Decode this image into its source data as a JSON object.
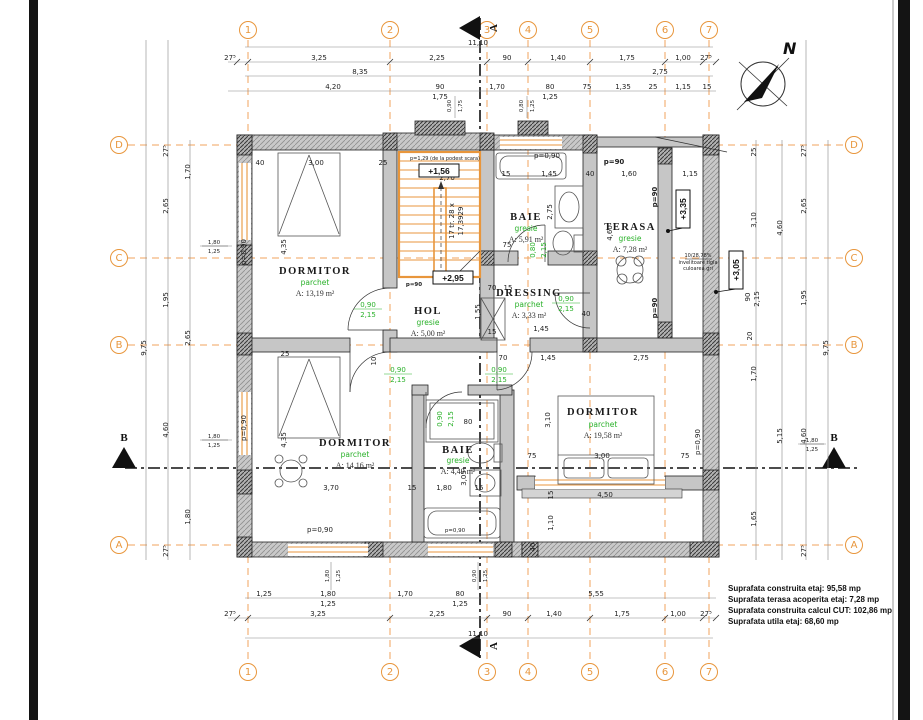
{
  "colors": {
    "axis": "#F0A35E",
    "finish_green": "#2AB12A",
    "wall_gray": "#C6C6C6"
  },
  "north": "N",
  "grid": {
    "cols": [
      "1",
      "2",
      "3",
      "4",
      "5",
      "6",
      "7"
    ],
    "rows": [
      "D",
      "C",
      "B",
      "A"
    ]
  },
  "section": {
    "vertical": "A",
    "horizontal": "B"
  },
  "rooms": [
    {
      "name": "DORMITOR",
      "finish": "parchet",
      "area": "A: 13,19 m²"
    },
    {
      "name": "HOL",
      "finish": "gresie",
      "area": "A: 5,00 m²"
    },
    {
      "name": "BAIE",
      "finish": "gresie",
      "area": "A: 5,91 m²"
    },
    {
      "name": "DRESSING",
      "finish": "parchet",
      "area": "A: 3,33 m²"
    },
    {
      "name": "TERASA",
      "finish": "gresie",
      "area": "A: 7,28 m²"
    },
    {
      "name": "DORMITOR",
      "finish": "parchet",
      "area": "A: 19,58 m²"
    },
    {
      "name": "DORMITOR",
      "finish": "parchet",
      "area": "A: 14,16 m²"
    },
    {
      "name": "BAIE",
      "finish": "gresie",
      "area": "A: 4,49 m²"
    }
  ],
  "levels": {
    "l1": "+1,56",
    "l2": "+2,95",
    "l3": "+3,35",
    "l4": "+3,05"
  },
  "stairs": {
    "note": "p=1,29 (de la podest scara)",
    "line1": "17 tr. 28 x",
    "line2": "17,3929"
  },
  "roof": {
    "l1": "10/28,78%",
    "l2": "invelitoare tigla",
    "l3": "culoarea gri"
  },
  "lbl": {
    "p090": "p=0,90",
    "p90": "p=90",
    "d09": "0,90",
    "d08": "0,80",
    "d215": "2,15"
  },
  "summary": [
    "Suprafata construita etaj: 95,58 mp",
    "Suprafata terasa acoperita etaj: 7,28 mp",
    "Suprafata construita calcul CUT: 102,86 mp",
    "Suprafata utila etaj: 68,60 mp"
  ],
  "dims": {
    "t1": [
      "11,10"
    ],
    "t2": [
      "27⁵",
      "3,25",
      "2,25",
      "90",
      "1,40",
      "1,75",
      "1,00",
      "27⁵"
    ],
    "t3": [
      "8,35",
      "2,75"
    ],
    "t4": [
      "4,20",
      "90",
      "1,75",
      "1,70",
      "80",
      "1,25",
      "75",
      "1,35",
      "25",
      "1,15",
      "15"
    ],
    "ts": [
      "0,90",
      "1,75",
      "0,80",
      "1,25"
    ],
    "b1": [
      "1,25",
      "1,80",
      "1,25",
      "1,70",
      "80",
      "1,25",
      "5,55"
    ],
    "b2": [
      "27⁵",
      "3,25",
      "2,25",
      "90",
      "1,40",
      "1,75",
      "1,00",
      "27⁵"
    ],
    "b3": [
      "11,10"
    ],
    "bs": [
      "1,80",
      "1,25",
      "0,90",
      "1,25"
    ],
    "l": [
      "9,75",
      "27⁵",
      "1,70",
      "2,65",
      "1,80",
      "1,25",
      "1,95",
      "2,65",
      "4,60",
      "1,80",
      "1,25",
      "1,80",
      "27⁵"
    ],
    "r": [
      "25",
      "3,10",
      "4,60",
      "90",
      "2,15",
      "20",
      "1,70",
      "27⁵",
      "2,65",
      "1,95",
      "9,75",
      "4,60",
      "5,15",
      "1,80",
      "1,25",
      "1,65",
      "27⁵"
    ],
    "i": [
      "40",
      "3,00",
      "25",
      "2,70",
      "15",
      "1,45",
      "40",
      "1,60",
      "1,15",
      "4,35",
      "2,75",
      "4,60",
      "75",
      "70",
      "15",
      "1,55",
      "15",
      "1,45",
      "40",
      "70",
      "1,45",
      "2,75",
      "3,10",
      "75",
      "3,00",
      "75",
      "4,50",
      "15",
      "1,10",
      "40",
      "3,70",
      "15",
      "1,80",
      "15",
      "4,35",
      "25",
      "10",
      "80",
      "3,05"
    ]
  }
}
